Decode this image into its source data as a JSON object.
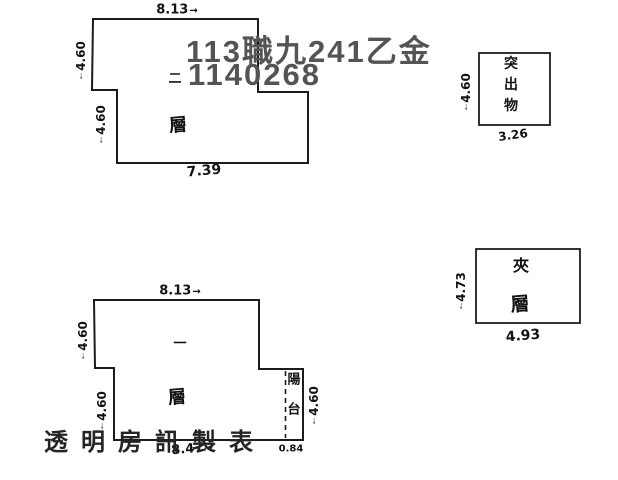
{
  "canvas": {
    "background": "#ffffff",
    "ink_color": "#1c1c1c"
  },
  "stamp": {
    "line1": "113職九241乙金",
    "line2": "1140268"
  },
  "watermark": {
    "text": "透明房訊製表"
  },
  "icons": {
    "arrow_right": "→",
    "arrow_down": "↓"
  },
  "second_floor_plan": {
    "floor_number_char": "二",
    "floor_char": "層",
    "dim_top": "8.13",
    "dim_left_upper": "4.60",
    "dim_left_lower": "4.60",
    "dim_bottom": "7.39"
  },
  "first_floor_plan": {
    "floor_number_char": "一",
    "floor_char": "層",
    "dim_top": "8.13",
    "dim_left_upper": "4.60",
    "dim_left_lower": "4.60",
    "dim_right": "4.60",
    "dim_bottom": "8.47",
    "dim_bottom_balcony": "0.84",
    "balcony_label": "陽台"
  },
  "protrusion_box": {
    "label": "突出物",
    "dim_left": "4.60",
    "dim_bottom": "3.26"
  },
  "mezzanine_box": {
    "label_char_top": "夾",
    "label_char_bottom": "層",
    "dim_left": "4.73",
    "dim_bottom": "4.93"
  }
}
